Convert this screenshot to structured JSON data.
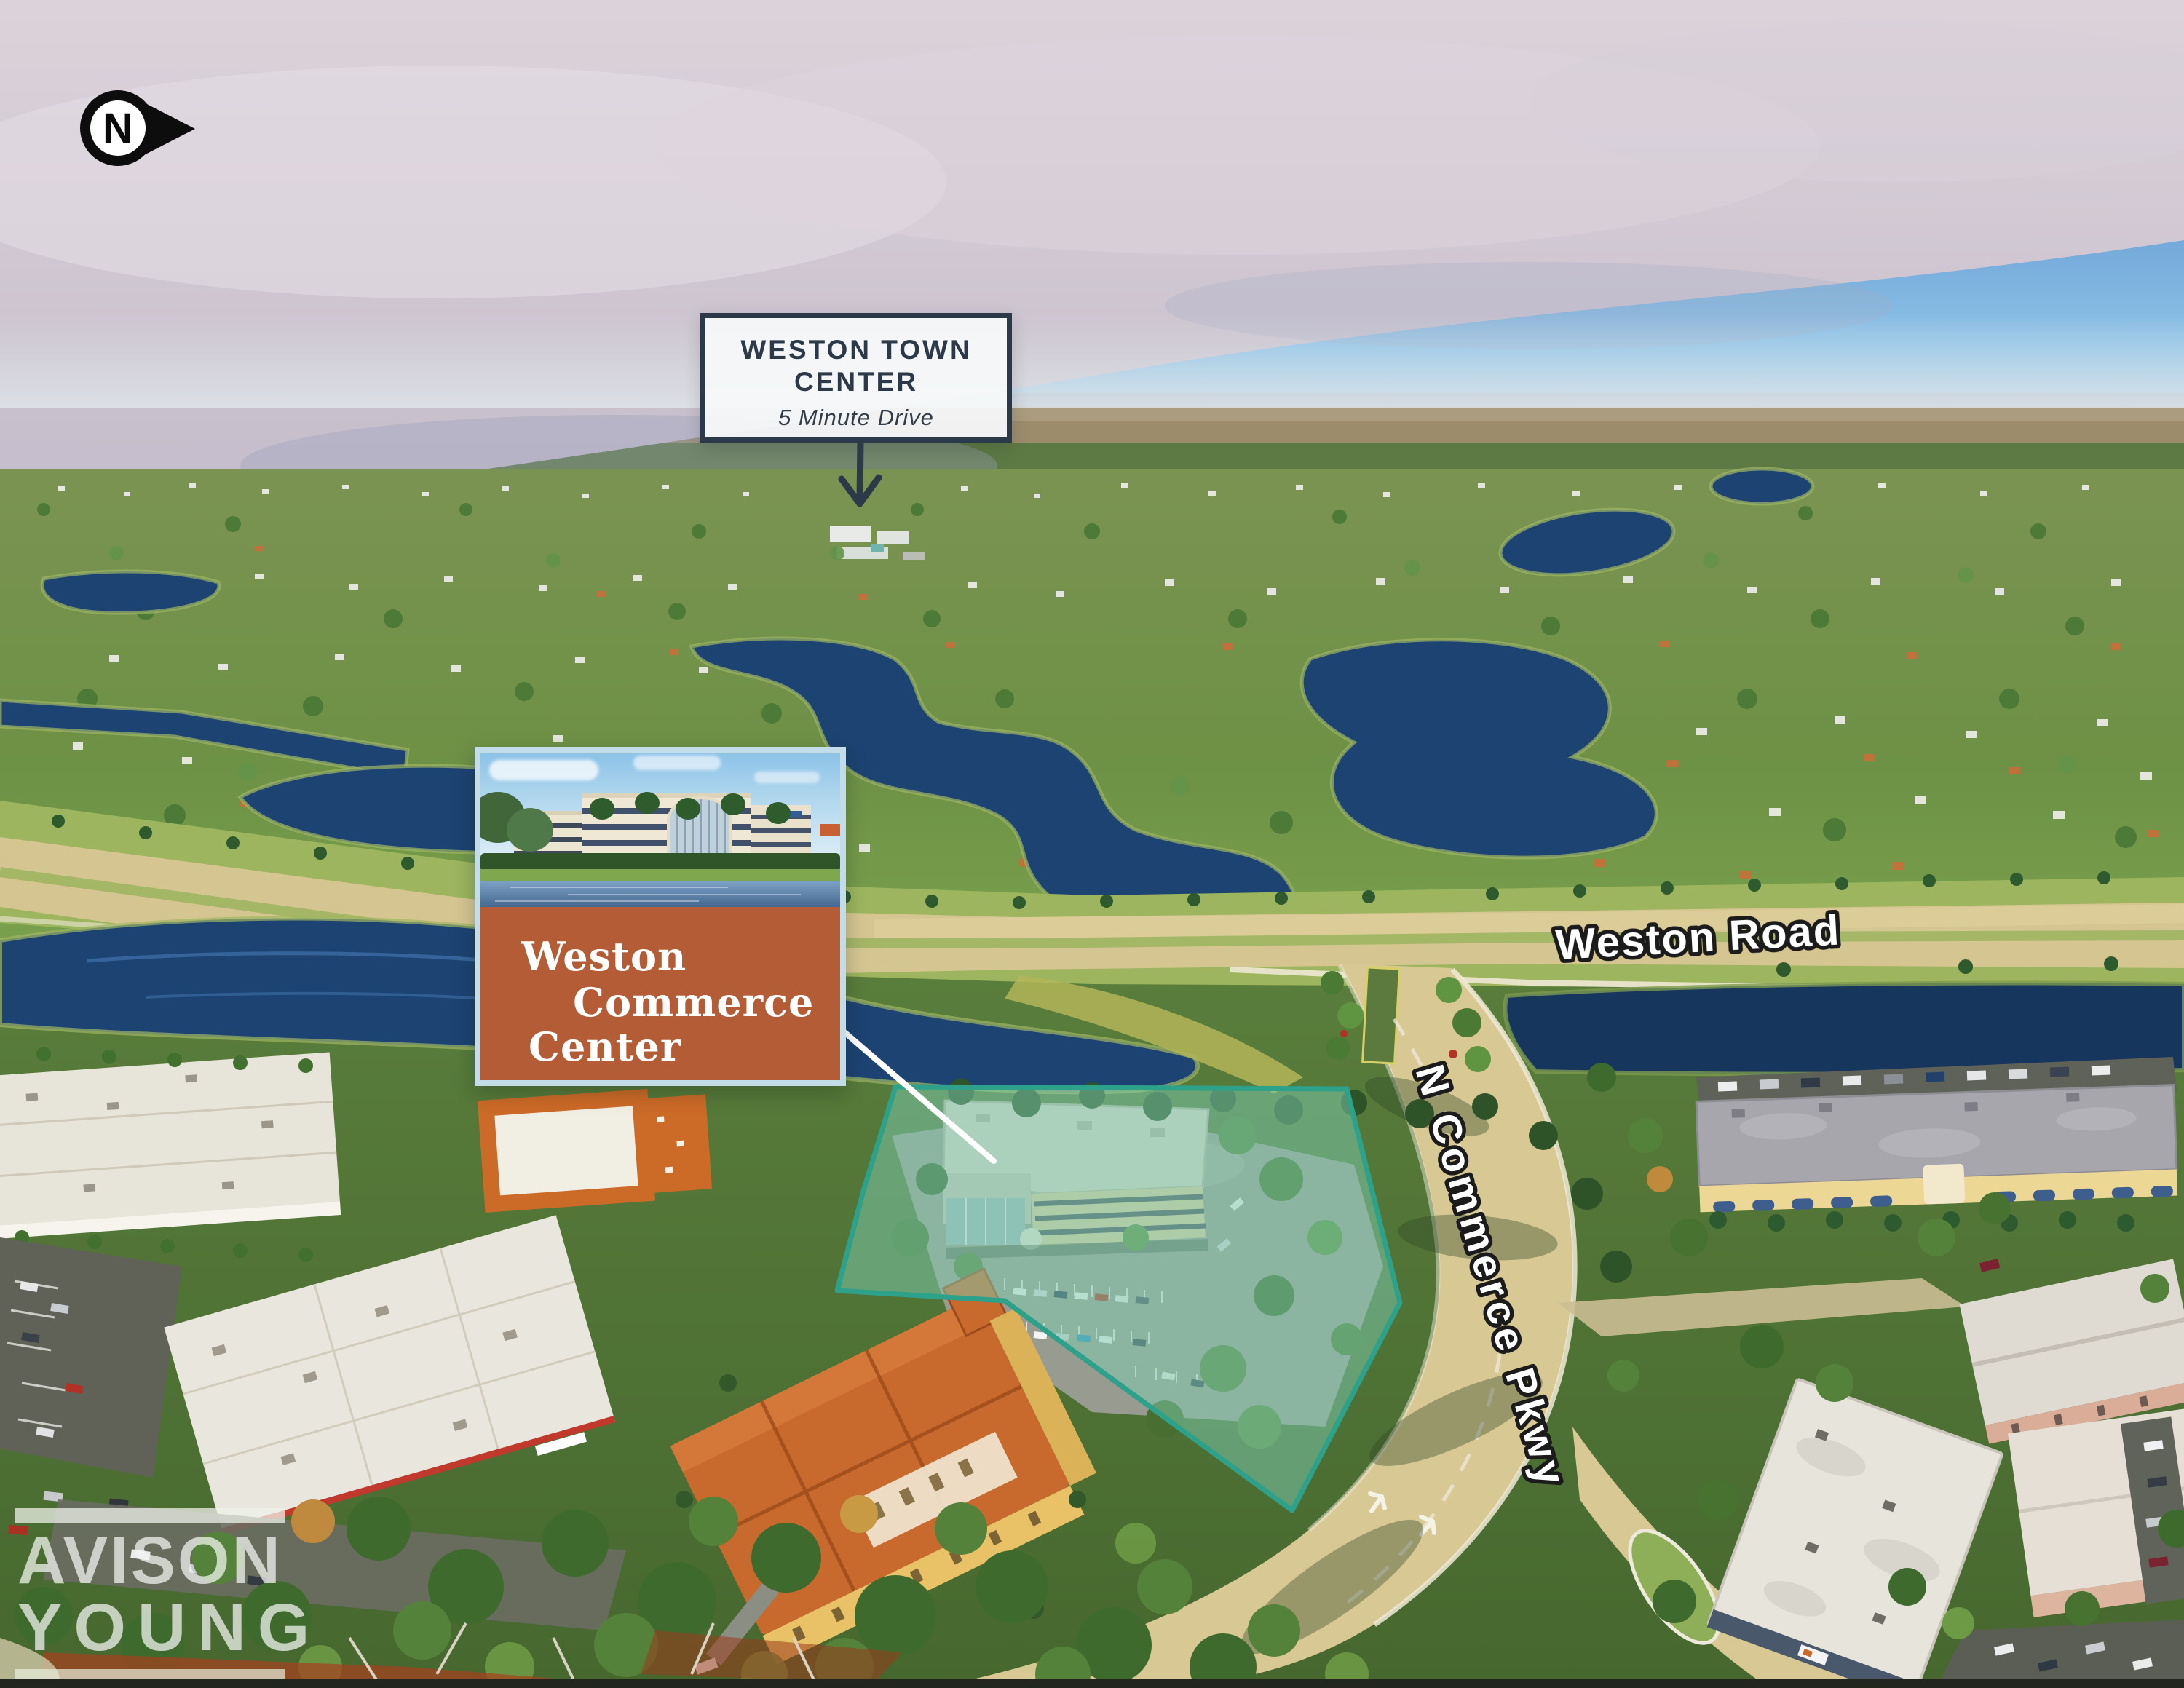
{
  "annotations": {
    "north_indicator": {
      "letter": "N"
    },
    "destination_callout": {
      "title": "WESTON TOWN CENTER",
      "subtitle": "5 Minute Drive"
    },
    "property_card": {
      "name_lines": [
        "Weston",
        "Commerce",
        "Center"
      ]
    },
    "road_labels": {
      "weston_road": "Weston Road",
      "commerce_pkwy": "N Commerce Pkwy"
    },
    "brand_watermark": {
      "lines": [
        "AVISON",
        "YOUNG"
      ]
    }
  },
  "colors": {
    "highlight_fill": "#7ECDB2",
    "highlight_outline": "#2DA189",
    "property_label_background": "#B35C35",
    "card_border": "#C2DDE8",
    "callout_border": "#2B3949",
    "callout_text": "#2B3949",
    "road_label_text": "#FFFFFF",
    "road_label_outline": "#1B1B1B",
    "north_marker": "#0D0D0D",
    "watermark_text": "rgba(240,243,240,0.75)",
    "water": "#1D4372",
    "road_tan": "#D5C591"
  }
}
